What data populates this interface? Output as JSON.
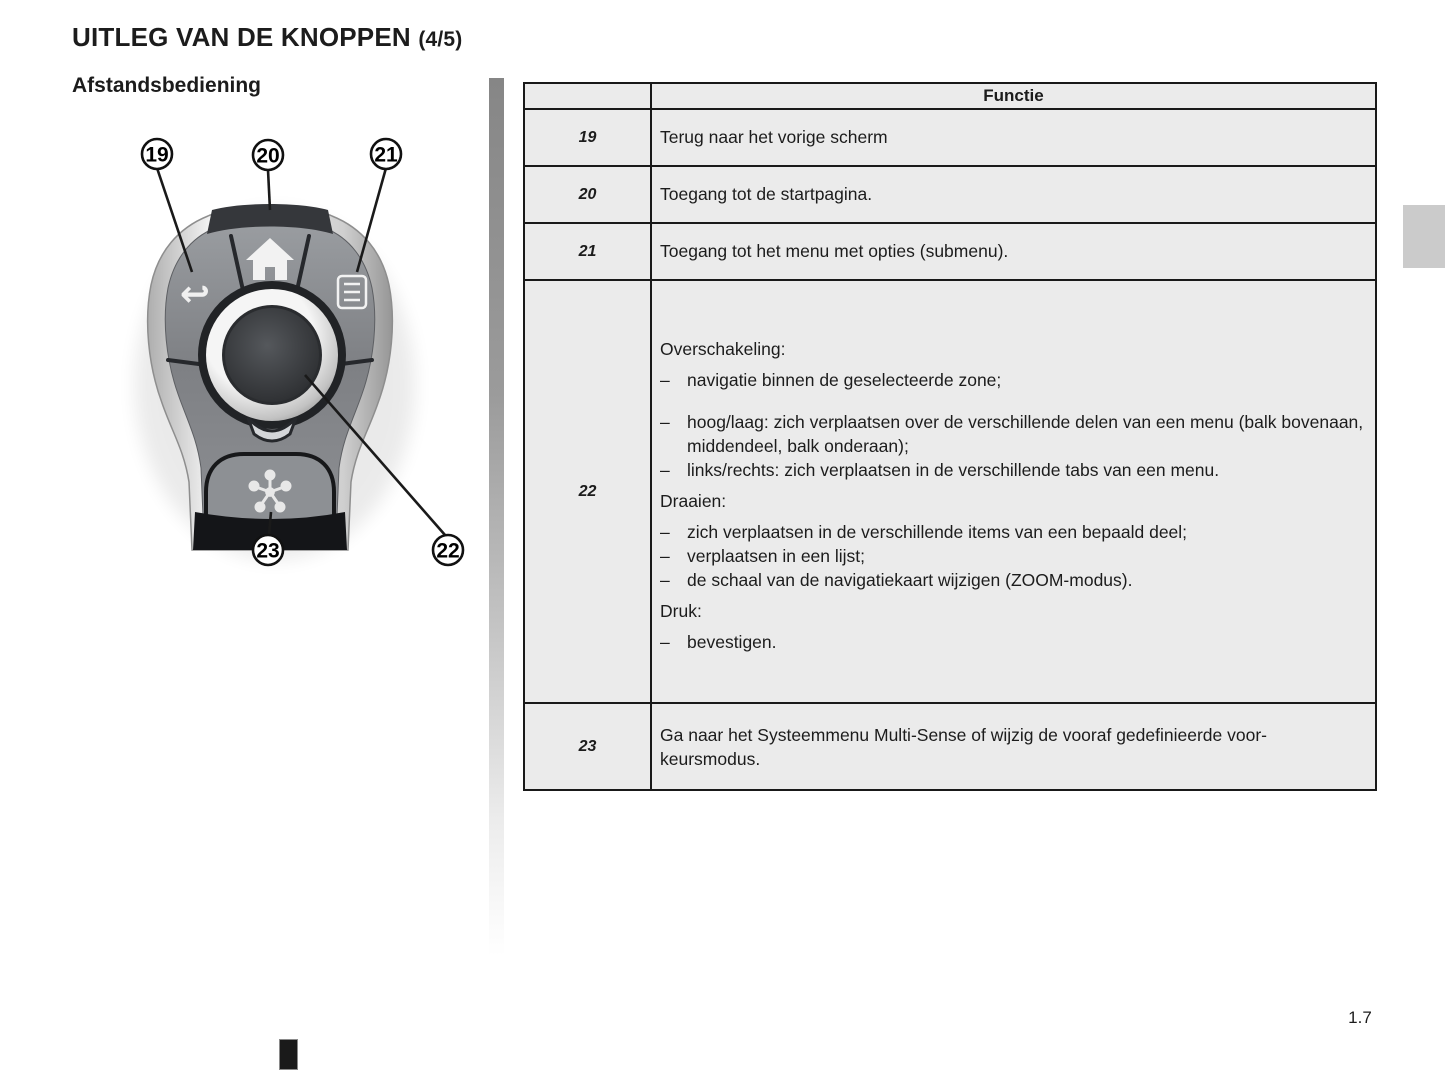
{
  "page": {
    "title": "UITLEG VAN DE KNOPPEN",
    "title_suffix": "(4/5)",
    "subtitle": "Afstandsbediening",
    "page_number": "1.7"
  },
  "ui": {
    "bullet_char": "–",
    "accent_colors": {
      "table_border": "#191919",
      "cell_background": "#ebebeb",
      "remote_body_chrome": "#c9c9c9",
      "remote_face_gray": "#85878b"
    }
  },
  "remote": {
    "callouts": [
      {
        "num": "19",
        "target": "back-button"
      },
      {
        "num": "20",
        "target": "home-button"
      },
      {
        "num": "21",
        "target": "options-menu-button"
      },
      {
        "num": "22",
        "target": "rotary-knob"
      },
      {
        "num": "23",
        "target": "multi-sense-button"
      }
    ],
    "icons": [
      "back-arrow-icon",
      "home-icon",
      "menu-list-icon",
      "rotary-knob",
      "multi-sense-flower-icon"
    ]
  },
  "table": {
    "header": "Functie",
    "rows": [
      {
        "num": "19",
        "text": "Terug naar het vorige scherm"
      },
      {
        "num": "20",
        "text": "Toegang tot de startpagina."
      },
      {
        "num": "21",
        "text": "Toegang tot het menu met opties (submenu)."
      },
      {
        "num": "22",
        "sections": [
          {
            "label": "Overschakeling:",
            "items": [
              "navigatie binnen de geselecteerde zone;",
              "hoog/laag: zich verplaatsen over de verschillende delen van een menu (balk bovenaan, middendeel, balk onderaan);",
              "links/rechts: zich verplaatsen in de verschillende tabs van een menu."
            ]
          },
          {
            "label": "Draaien:",
            "items": [
              "zich verplaatsen in de verschillende items van een bepaald deel;",
              "verplaatsen in een lijst;",
              "de schaal van de navigatiekaart wijzigen (ZOOM-modus)."
            ]
          },
          {
            "label": "Druk:",
            "items": [
              "bevestigen."
            ]
          }
        ]
      },
      {
        "num": "23",
        "text": "Ga naar het Systeemmenu Multi-Sense  of wijzig de vooraf gedefinieerde voor-\nkeursmodus."
      }
    ]
  }
}
